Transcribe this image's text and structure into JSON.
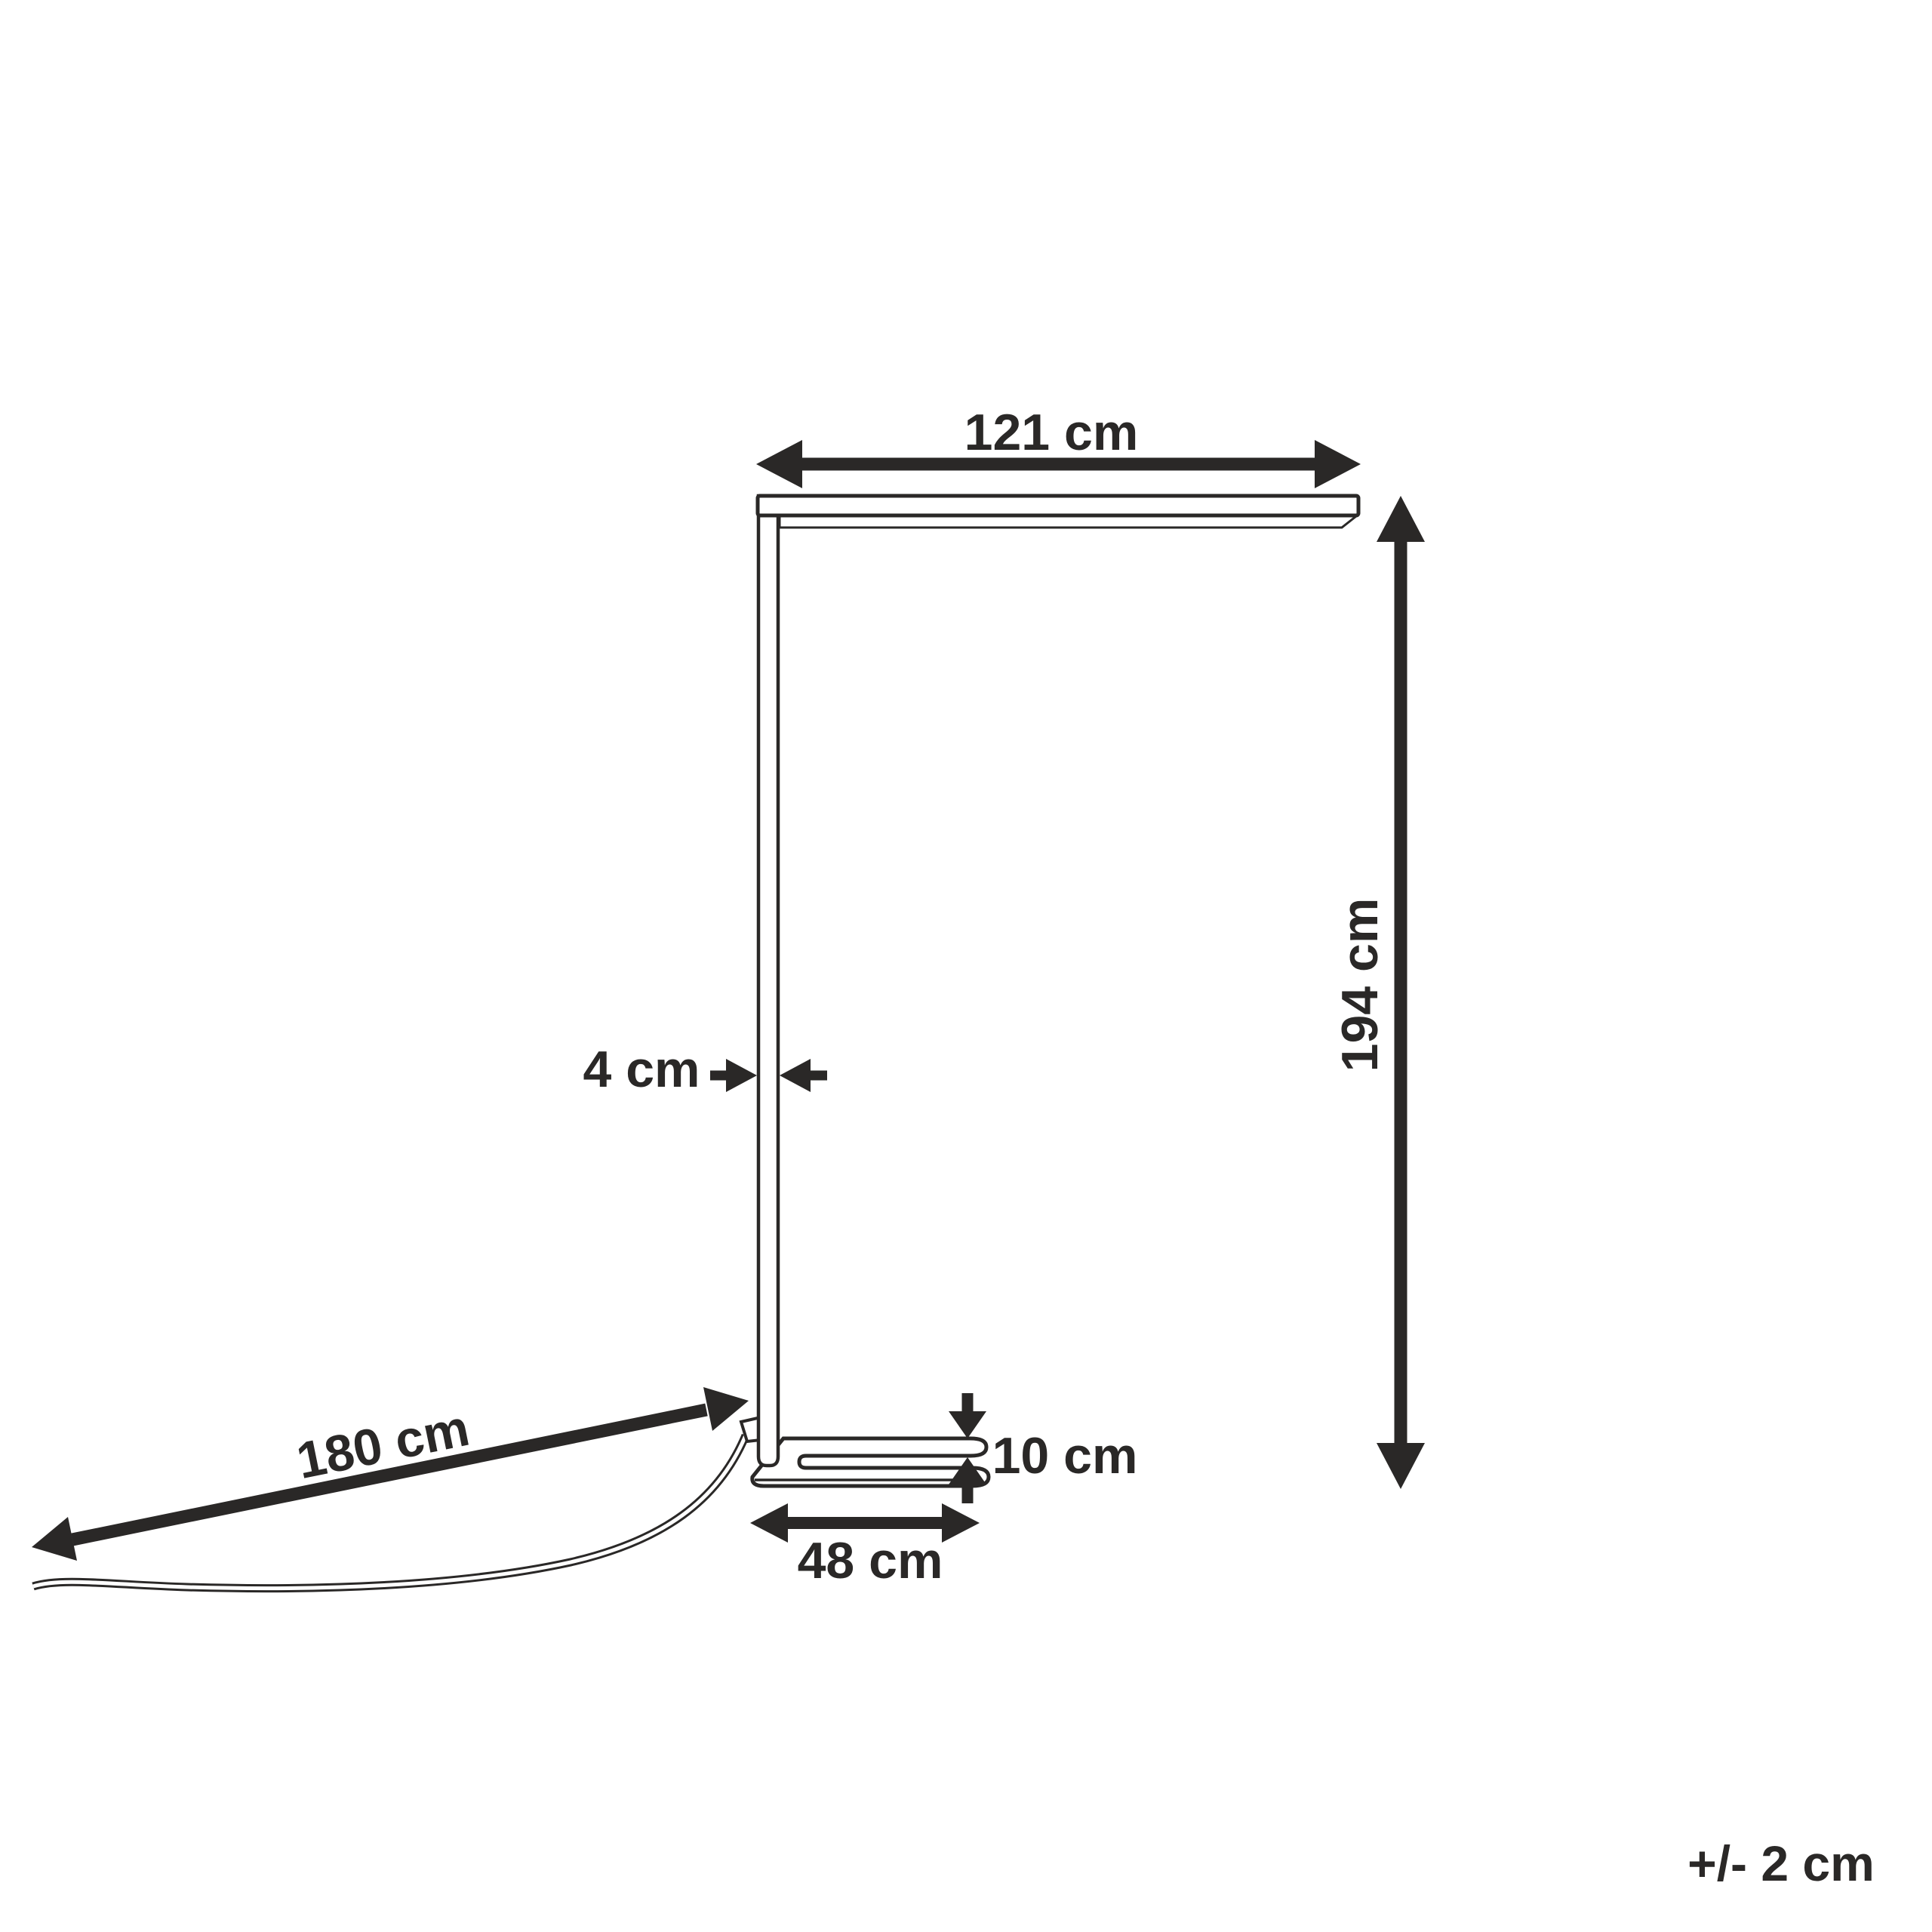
{
  "diagram": {
    "background": "#ffffff",
    "ink": "#2a2827",
    "labels": {
      "head_width": "121 cm",
      "lamp_height": "194 cm",
      "pole_width": "4 cm",
      "base_height": "10 cm",
      "base_depth": "48 cm",
      "cable_length": "180 cm"
    },
    "tolerance": "+/- 2 cm"
  }
}
